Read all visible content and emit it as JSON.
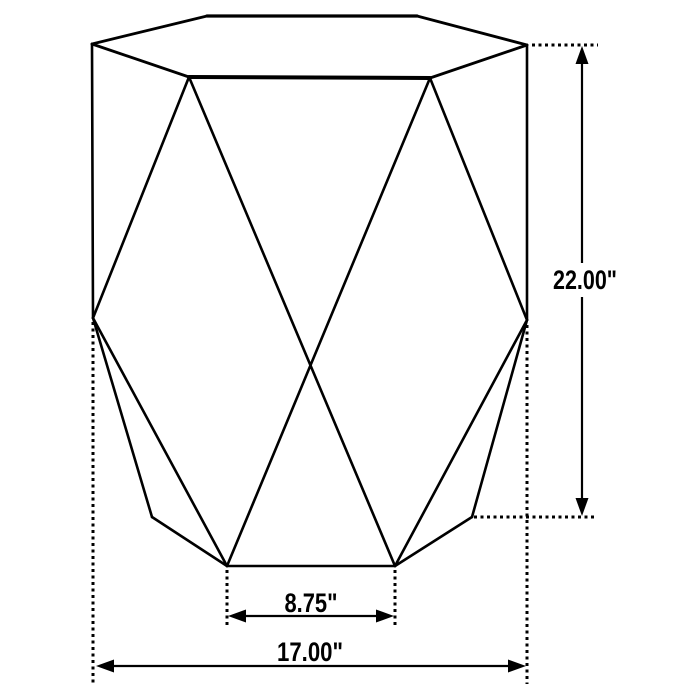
{
  "diagram": {
    "type": "furniture-dimension-drawing",
    "subject": "hexagonal geometric accent table",
    "colors": {
      "line": "#000000",
      "background": "#ffffff"
    },
    "dimensions": {
      "height_label": "22.00\"",
      "inner_width_label": "8.75\"",
      "overall_width_label": "17.00\""
    }
  }
}
